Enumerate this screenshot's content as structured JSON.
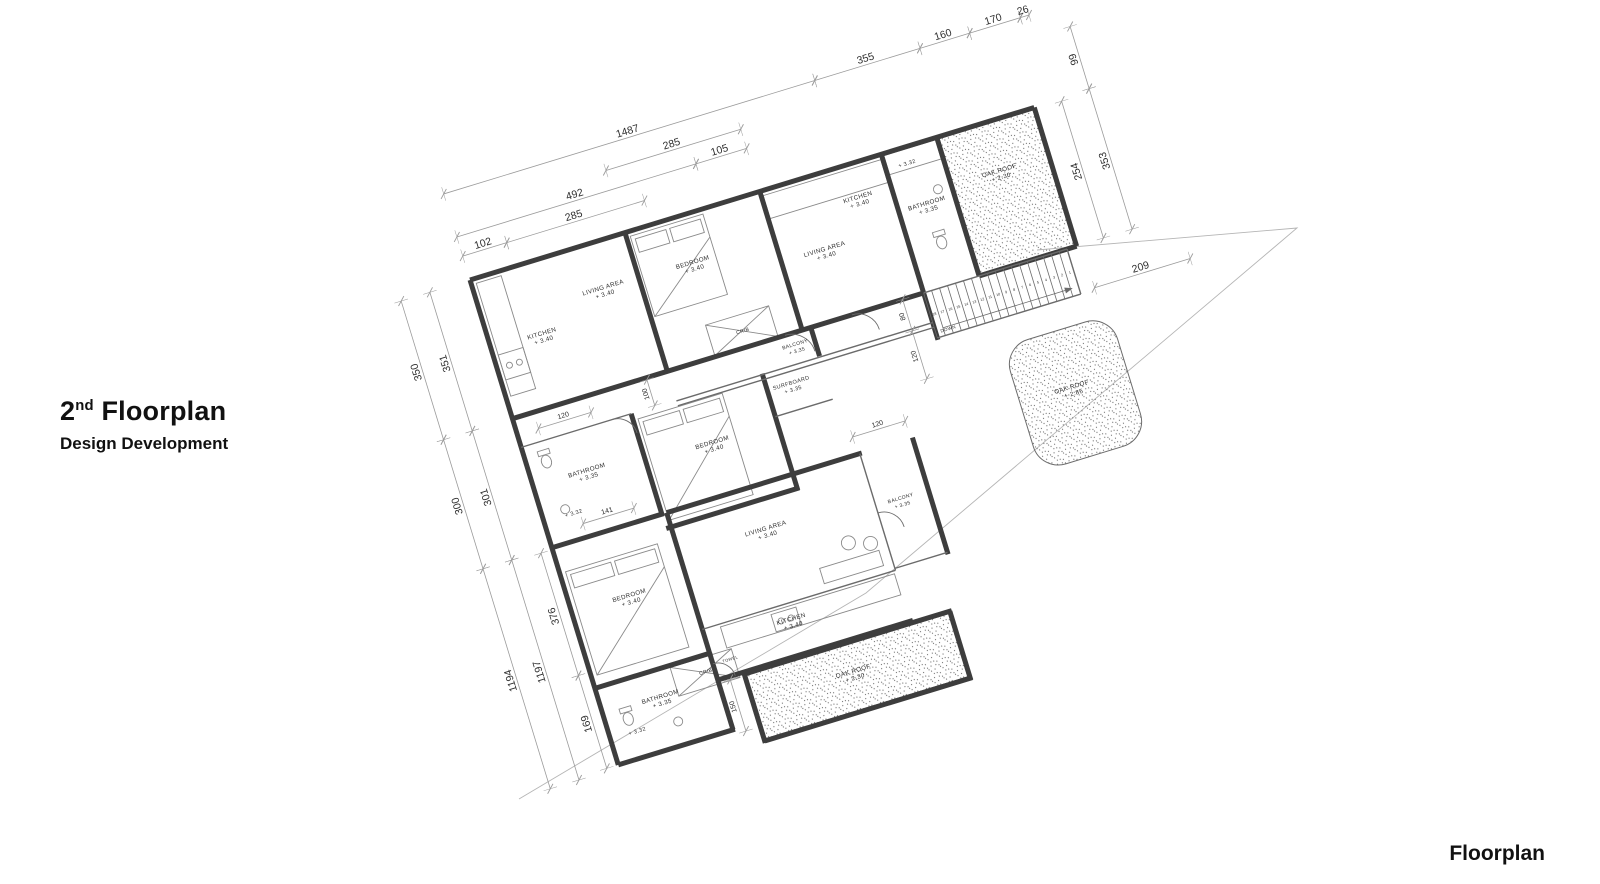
{
  "title": {
    "prefix": "2",
    "ordinal": "nd",
    "name": " Floorplan",
    "subtitle": "Design Development"
  },
  "footer": {
    "label": "Floorplan"
  },
  "plan": {
    "rotation_deg": -17,
    "tx": -33.4,
    "ty": 172.5,
    "colors": {
      "wall": "#3d3d3d",
      "partition": "#6b6b6b",
      "dimline": "#9b9b9b",
      "text": "#2e2e2e",
      "furniture": "#8a8a8a",
      "boundary": "#b5b5b5",
      "stipple": "#6f6f6f"
    },
    "boundary": [
      [
        1037,
        250
      ],
      [
        1297,
        228
      ],
      [
        866,
        593
      ],
      [
        519,
        799
      ]
    ],
    "roofs": [
      {
        "x": 940,
        "y": 252,
        "w": 98,
        "h": 141,
        "rx": 0
      },
      {
        "x": 599,
        "y": 709,
        "w": 211,
        "h": 66,
        "rx": 0
      },
      {
        "x": 940,
        "y": 470,
        "w": 112,
        "h": 130,
        "rx": 26
      }
    ],
    "walls": [
      [
        450,
        250,
        1040,
        250
      ],
      [
        450,
        250,
        450,
        757
      ],
      [
        1040,
        250,
        1040,
        395
      ],
      [
        938,
        250,
        938,
        395
      ],
      [
        880,
        250,
        880,
        444
      ],
      [
        753,
        250,
        753,
        395
      ],
      [
        612,
        250,
        612,
        397
      ],
      [
        450,
        395,
        612,
        395
      ],
      [
        612,
        395,
        882,
        395
      ],
      [
        938,
        395,
        1040,
        395
      ],
      [
        565,
        425,
        565,
        532
      ],
      [
        450,
        530,
        567,
        530
      ],
      [
        565,
        545,
        704,
        545
      ],
      [
        702,
        425,
        702,
        547
      ],
      [
        570,
        530,
        570,
        679
      ],
      [
        570,
        530,
        774,
        530
      ],
      [
        827,
        530,
        827,
        652
      ],
      [
        450,
        677,
        572,
        677
      ],
      [
        570,
        677,
        570,
        757
      ],
      [
        450,
        757,
        572,
        757
      ],
      [
        570,
        705,
        774,
        705
      ],
      [
        597,
        707,
        814,
        707
      ],
      [
        812,
        707,
        812,
        779
      ],
      [
        597,
        777,
        814,
        777
      ],
      [
        597,
        707,
        597,
        779
      ],
      [
        762,
        395,
        762,
        425
      ]
    ],
    "partitions": [
      [
        450,
        425,
        565,
        425
      ],
      [
        702,
        470,
        762,
        470
      ],
      [
        570,
        652,
        772,
        652
      ],
      [
        772,
        530,
        772,
        652
      ],
      [
        772,
        650,
        827,
        650
      ],
      [
        612,
        426,
        880,
        426
      ],
      [
        612,
        431,
        880,
        431
      ],
      [
        880,
        395,
        1030,
        395
      ],
      [
        880,
        442,
        1030,
        442
      ],
      [
        1030,
        395,
        1030,
        442
      ]
    ],
    "stairs": {
      "x": 880,
      "y": 395,
      "w": 150,
      "h": 47,
      "treads": [
        18,
        17,
        16,
        15,
        14,
        13,
        12,
        11,
        10,
        9,
        8,
        7,
        6,
        5,
        4,
        3,
        2,
        1
      ]
    },
    "dims": [
      {
        "x1": 450,
        "y1": 160,
        "x2": 838,
        "y2": 160,
        "t": "1487"
      },
      {
        "x1": 838,
        "y1": 160,
        "x2": 948,
        "y2": 160,
        "t": "355"
      },
      {
        "x1": 948,
        "y1": 160,
        "x2": 1000,
        "y2": 160,
        "t": "160"
      },
      {
        "x1": 1000,
        "y1": 160,
        "x2": 1053,
        "y2": 160,
        "t": "170"
      },
      {
        "x1": 1053,
        "y1": 160,
        "x2": 1062,
        "y2": 160,
        "t": "26"
      },
      {
        "x1": 612,
        "y1": 185,
        "x2": 753,
        "y2": 185,
        "t": "285"
      },
      {
        "x1": 450,
        "y1": 205,
        "x2": 700,
        "y2": 205,
        "t": "492"
      },
      {
        "x1": 700,
        "y1": 205,
        "x2": 753,
        "y2": 205,
        "t": "105"
      },
      {
        "x1": 450,
        "y1": 225,
        "x2": 496,
        "y2": 225,
        "t": "102"
      },
      {
        "x1": 496,
        "y1": 225,
        "x2": 640,
        "y2": 225,
        "t": "285"
      },
      {
        "x1": 1098,
        "y1": 183,
        "x2": 1098,
        "y2": 248,
        "t": "99"
      },
      {
        "x1": 1098,
        "y1": 248,
        "x2": 1098,
        "y2": 395,
        "t": "353"
      },
      {
        "x1": 1068,
        "y1": 252,
        "x2": 1068,
        "y2": 395,
        "t": "254"
      },
      {
        "x1": 1045,
        "y1": 440,
        "x2": 1145,
        "y2": 440,
        "t": "209"
      },
      {
        "x1": 378,
        "y1": 250,
        "x2": 378,
        "y2": 395,
        "t": "350"
      },
      {
        "x1": 378,
        "y1": 395,
        "x2": 378,
        "y2": 530,
        "t": "300"
      },
      {
        "x1": 378,
        "y1": 530,
        "x2": 378,
        "y2": 760,
        "t": "1194"
      },
      {
        "x1": 408,
        "y1": 250,
        "x2": 408,
        "y2": 395,
        "t": "351"
      },
      {
        "x1": 408,
        "y1": 395,
        "x2": 408,
        "y2": 530,
        "t": "301"
      },
      {
        "x1": 408,
        "y1": 530,
        "x2": 408,
        "y2": 760,
        "t": "1197"
      },
      {
        "x1": 438,
        "y1": 532,
        "x2": 438,
        "y2": 660,
        "t": "376"
      },
      {
        "x1": 438,
        "y1": 660,
        "x2": 438,
        "y2": 757,
        "t": "169"
      },
      {
        "x1": 590,
        "y1": 397,
        "x2": 590,
        "y2": 424,
        "t": "100",
        "s": 7
      },
      {
        "x1": 472,
        "y1": 412,
        "x2": 527,
        "y2": 412,
        "t": "120",
        "s": 7
      },
      {
        "x1": 487,
        "y1": 516,
        "x2": 540,
        "y2": 516,
        "t": "141",
        "s": 7
      },
      {
        "x1": 858,
        "y1": 395,
        "x2": 858,
        "y2": 428,
        "t": "80",
        "s": 7
      },
      {
        "x1": 858,
        "y1": 428,
        "x2": 858,
        "y2": 478,
        "t": "120",
        "s": 7
      },
      {
        "x1": 770,
        "y1": 512,
        "x2": 825,
        "y2": 512,
        "t": "120",
        "s": 7
      },
      {
        "x1": 582,
        "y1": 708,
        "x2": 582,
        "y2": 762,
        "t": "150",
        "s": 7
      }
    ],
    "room_labels": [
      {
        "n": "KITCHEN",
        "l": "+ 3.40",
        "x": 503,
        "y": 324
      },
      {
        "n": "LIVING AREA",
        "l": "+ 3.40",
        "x": 575,
        "y": 298
      },
      {
        "n": "BEDROOM",
        "l": "+ 3.40",
        "x": 668,
        "y": 300
      },
      {
        "n": "CRIB",
        "l": "",
        "x": 696,
        "y": 380,
        "s": 5
      },
      {
        "n": "LIVING AREA",
        "l": "+ 3.40",
        "x": 798,
        "y": 326
      },
      {
        "n": "KITCHEN",
        "l": "+ 3.40",
        "x": 845,
        "y": 286
      },
      {
        "n": "BATHROOM",
        "l": "+ 3.35",
        "x": 909,
        "y": 312
      },
      {
        "n": "OAK ROOF",
        "l": "+ 2.30",
        "x": 988,
        "y": 302
      },
      {
        "n": "BALCONY",
        "l": "+ 3.35",
        "x": 742,
        "y": 408,
        "s": 5
      },
      {
        "n": "BATHROOM",
        "l": "+ 3.35",
        "x": 506,
        "y": 468
      },
      {
        "n": "BEDROOM",
        "l": "+ 3.40",
        "x": 634,
        "y": 478
      },
      {
        "n": "SURFBOARD",
        "l": "+ 3.35",
        "x": 727,
        "y": 444,
        "s": 5.5
      },
      {
        "n": "OAK ROOF",
        "l": "+ 2.85",
        "x": 994,
        "y": 530
      },
      {
        "n": "LIVING AREA",
        "l": "+ 3.40",
        "x": 660,
        "y": 576
      },
      {
        "n": "BALCONY",
        "l": "+ 3.35",
        "x": 798,
        "y": 586,
        "s": 5
      },
      {
        "n": "BEDROOM",
        "l": "+ 3.40",
        "x": 510,
        "y": 600
      },
      {
        "n": "CRIB",
        "l": "",
        "x": 561,
        "y": 695,
        "s": 5
      },
      {
        "n": "KITCHEN",
        "l": "+ 3.40",
        "x": 658,
        "y": 670
      },
      {
        "n": "TOWEL",
        "l": "",
        "x": 588,
        "y": 690,
        "s": 4
      },
      {
        "n": "BATHROOM",
        "l": "+ 3.35",
        "x": 510,
        "y": 706
      },
      {
        "n": "OAK ROOF",
        "l": "+ 2.30",
        "x": 702,
        "y": 738
      },
      {
        "n": "DOWN",
        "l": "",
        "x": 893,
        "y": 438,
        "s": 4.5
      },
      {
        "n": "+ 3.32",
        "l": "",
        "x": 902,
        "y": 268,
        "s": 5.5
      },
      {
        "n": "+ 3.32",
        "l": "",
        "x": 481,
        "y": 505,
        "s": 5.5
      },
      {
        "n": "+ 3.32",
        "l": "",
        "x": 478,
        "y": 732,
        "s": 5.5
      }
    ],
    "furniture": {
      "beds": [
        {
          "x": 616,
          "y": 255,
          "w": 76,
          "h": 84
        },
        {
          "x": 570,
          "y": 432,
          "w": 88,
          "h": 106
        },
        {
          "x": 456,
          "y": 557,
          "w": 96,
          "h": 108
        }
      ],
      "cribs": [
        {
          "x": 662,
          "y": 362,
          "w": 66,
          "h": 32
        },
        {
          "x": 528,
          "y": 679,
          "w": 64,
          "h": 30
        }
      ],
      "toilets": [
        {
          "x": 470,
          "y": 446
        },
        {
          "x": 473,
          "y": 716
        },
        {
          "x": 912,
          "y": 352
        }
      ],
      "sinks": [
        {
          "x": 474,
          "y": 497
        },
        {
          "x": 520,
          "y": 733
        },
        {
          "x": 924,
          "y": 300
        }
      ],
      "counters": [
        {
          "x": 455,
          "y": 255,
          "w": 26,
          "h": 118
        },
        {
          "x": 755,
          "y": 255,
          "w": 123,
          "h": 24
        },
        {
          "x": 588,
          "y": 655,
          "w": 182,
          "h": 22
        },
        {
          "x": 882,
          "y": 252,
          "w": 54,
          "h": 20
        }
      ],
      "stoves": [
        {
          "x": 455,
          "y": 330,
          "w": 26,
          "h": 26
        },
        {
          "x": 640,
          "y": 658,
          "w": 26,
          "h": 18
        }
      ],
      "sofa": {
        "x": 700,
        "y": 628,
        "w": 62,
        "h": 16
      },
      "chairs": [
        {
          "x": 735,
          "y": 612
        },
        {
          "x": 756,
          "y": 619
        }
      ]
    }
  }
}
